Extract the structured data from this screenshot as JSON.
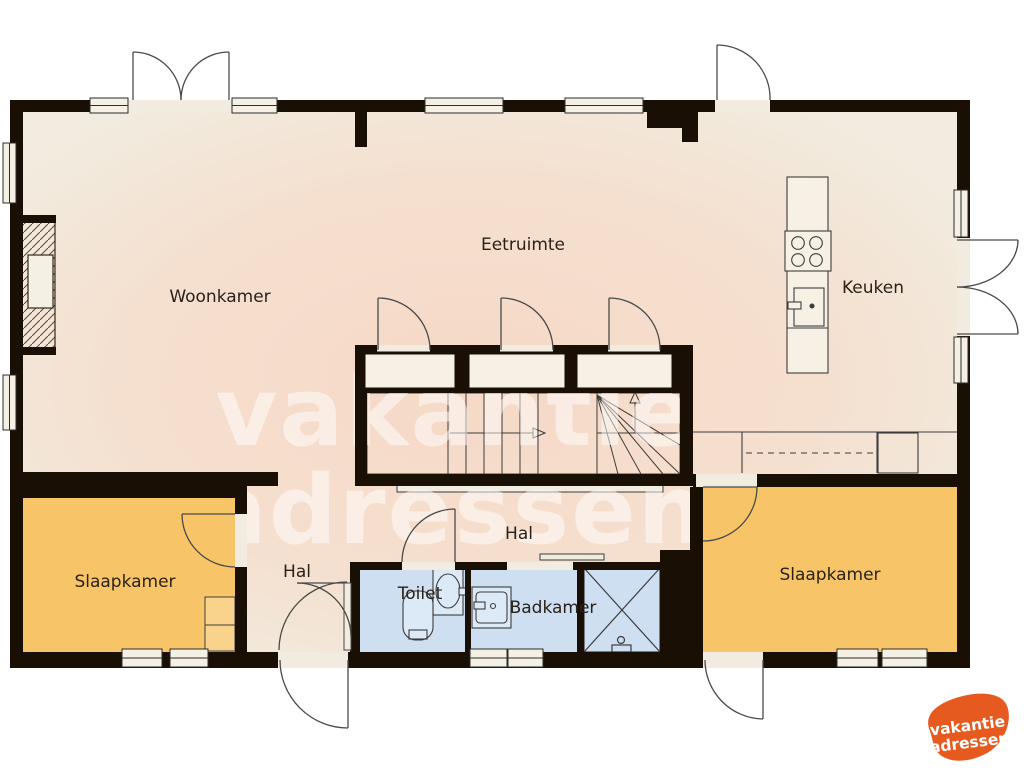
{
  "page": {
    "background": "#ffffff",
    "type": "floorplan"
  },
  "colors": {
    "wall": "#1a0f04",
    "floor": "#f1ecdf",
    "blob": "#f7d9c4",
    "bedroom": "#f7c568",
    "wardrobe": "#f9d28b",
    "bath": "#cddff1",
    "bath_fixture": "#dce9f6",
    "fixture_fill": "#f6f1e4",
    "window_fill": "#f4f0e3",
    "line": "#3c3c3c",
    "label": "#2a221a",
    "watermark": "#ffffff",
    "logo": "#e65a1f",
    "logo_text": "#ffffff"
  },
  "labels": {
    "woonkamer": "Woonkamer",
    "eetruimte": "Eetruimte",
    "keuken": "Keuken",
    "hal_upper": "Hal",
    "hal_lower": "Hal",
    "toilet": "Toilet",
    "badkamer": "Badkamer",
    "slaapkamer_left": "Slaapkamer",
    "slaapkamer_right": "Slaapkamer"
  },
  "watermark": {
    "line1": "vakantie",
    "line2": "adressen"
  },
  "logo": {
    "line1": "vakantie",
    "line2": "adressen"
  }
}
